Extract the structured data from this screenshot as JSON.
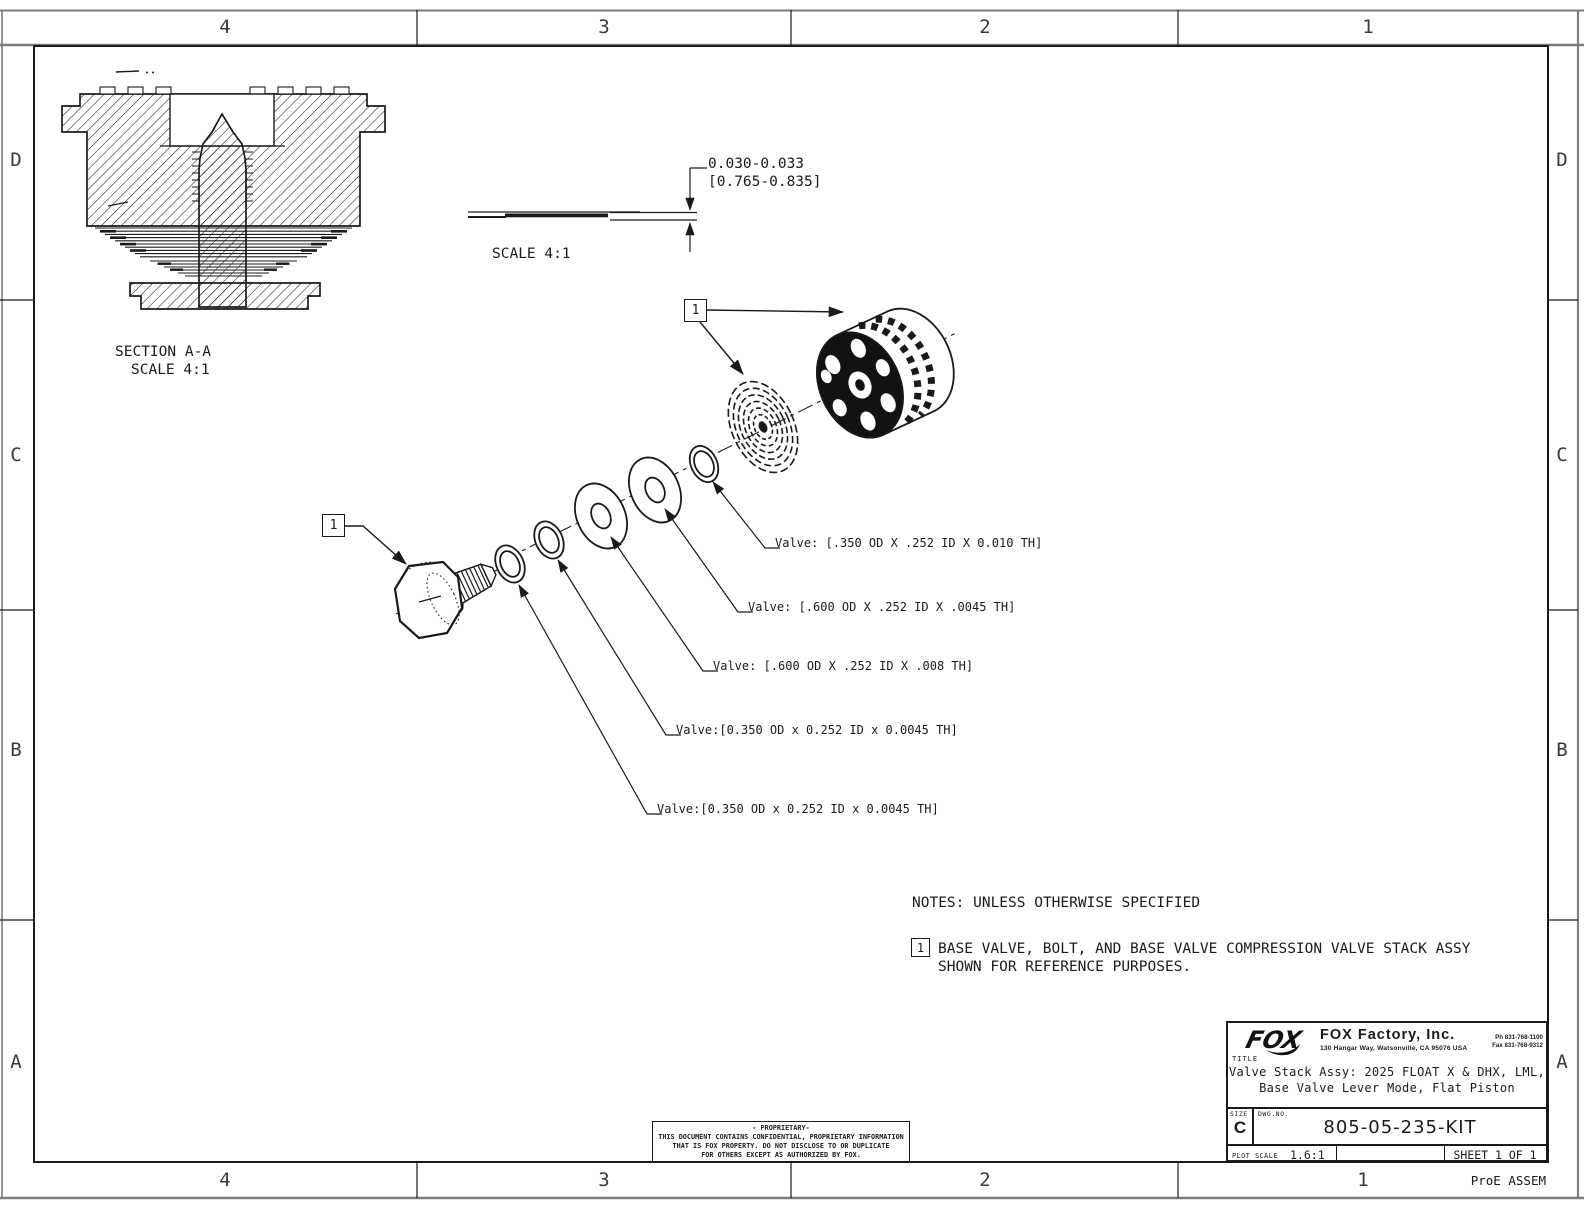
{
  "sheet": {
    "zones_top": [
      "4",
      "3",
      "2",
      "1"
    ],
    "zones_bottom": [
      "4",
      "3",
      "2",
      "1"
    ],
    "zones_left": [
      "D",
      "C",
      "B",
      "A"
    ],
    "zones_right": [
      "D",
      "C",
      "B",
      "A"
    ],
    "bottom_right_label": "ProE ASSEM"
  },
  "section_view": {
    "caption_line1": "SECTION A-A",
    "caption_line2": "SCALE 4:1"
  },
  "detail_view": {
    "dim_line1": "0.030-0.033",
    "dim_line2": "[0.765-0.835]",
    "caption": "SCALE 4:1"
  },
  "exploded_view": {
    "flag_left": "1",
    "flag_right": "1",
    "valve_labels": [
      "Valve: [.350 OD X .252 ID X 0.010 TH]",
      "Valve: [.600 OD X .252 ID X .0045 TH]",
      "Valve: [.600 OD X .252 ID X .008 TH]",
      "Valve:[0.350 OD x 0.252 ID x 0.0045 TH]",
      "Valve:[0.350 OD x 0.252 ID x 0.0045 TH]"
    ]
  },
  "notes": {
    "header": "NOTES: UNLESS OTHERWISE SPECIFIED",
    "flag": "1",
    "note_line1": "BASE VALVE, BOLT, AND BASE VALVE COMPRESSION VALVE STACK ASSY",
    "note_line2": "SHOWN FOR REFERENCE PURPOSES."
  },
  "proprietary": {
    "line1": "- PROPRIETARY-",
    "line2": "THIS DOCUMENT CONTAINS CONFIDENTIAL, PROPRIETARY INFORMATION",
    "line3": "THAT IS FOX PROPERTY.  DO NOT DISCLOSE TO OR DUPLICATE",
    "line4": "FOR OTHERS EXCEPT AS AUTHORIZED BY FOX."
  },
  "title_block": {
    "logo_text": "FOX",
    "company": "FOX Factory, Inc.",
    "address": "130 Hangar Way, Watsonville, CA 95076 USA",
    "phone": "Ph 831-768-1100",
    "fax": "Fax 831-768-9312",
    "title_label": "TITLE",
    "title_line1": "Valve Stack Assy: 2025 FLOAT X & DHX, LML,",
    "title_line2": "Base Valve Lever Mode, Flat Piston",
    "size_label": "SIZE",
    "size_value": "C",
    "dwg_label": "DWG.NO.",
    "dwg_number": "805-05-235-KIT",
    "plot_scale_label": "PLOT SCALE",
    "plot_scale_value": "1.6:1",
    "sheet_label": "SHEET 1 OF 1"
  },
  "colors": {
    "line": "#1a1a1a",
    "band": "#7d7d7d",
    "background": "#ffffff"
  }
}
